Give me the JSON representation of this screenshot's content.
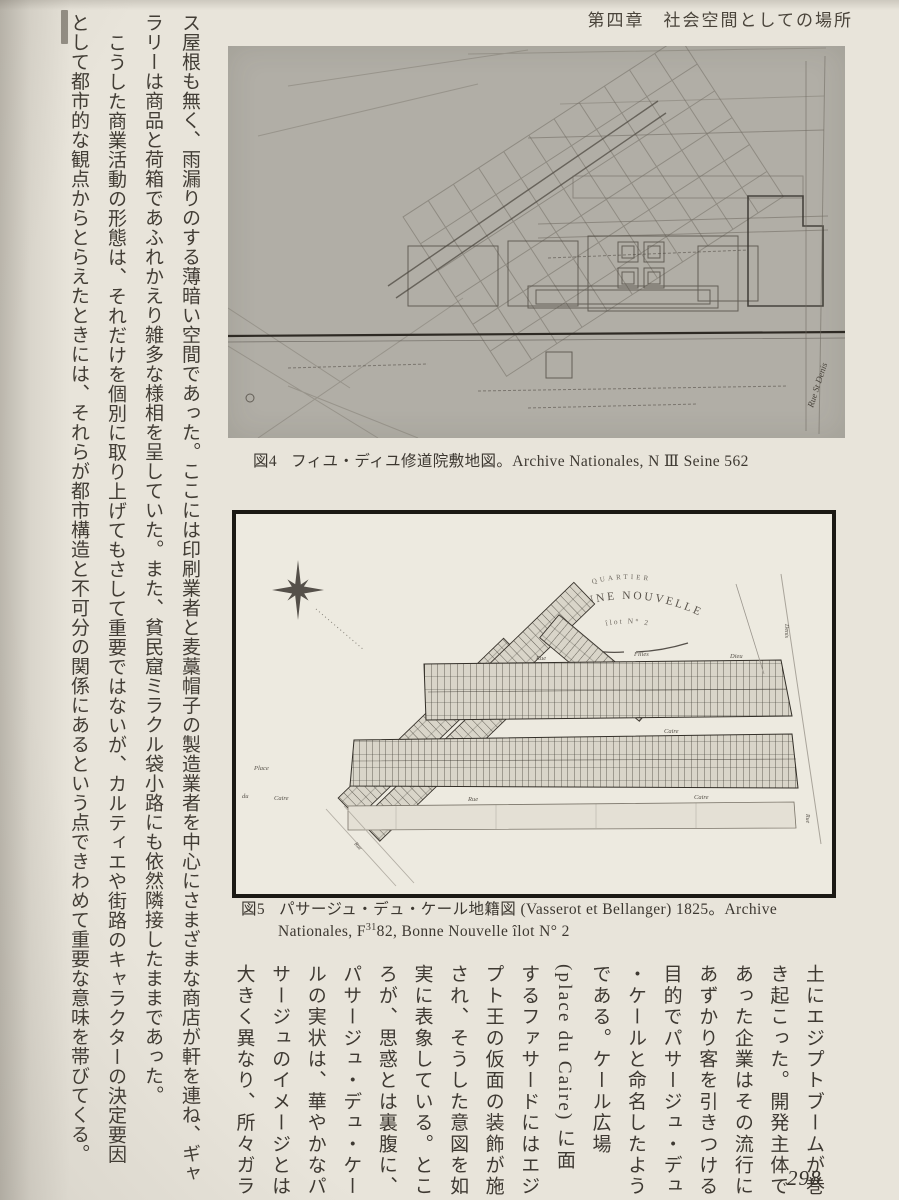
{
  "page": {
    "header": "第四章　社会空間としての場所",
    "page_number": "298"
  },
  "left_text": {
    "columns": [
      "ス屋根も無く、雨漏りのする薄暗い空間であった。ここには印刷業者と麦藁帽子の製造業者を中心にさまざまな商店が軒を連ね、ギャ",
      "ラリーは商品と荷箱であふれかえり雑多な様相を呈していた。また、貧民窟ミラクル袋小路にも依然隣接したままであった。",
      "こうした商業活動の形態は、それだけを個別に取り上げてもさして重要ではないが、カルティエや街路のキャラクターの決定要因",
      "として都市的な観点からとらえたときには、それらが都市構造と不可分の関係にあるという点できわめて重要な意味を帯びてくる。"
    ]
  },
  "figure4": {
    "caption_label": "図4",
    "caption_text": "フィユ・ディユ修道院敷地図。Archive Nationales, N Ⅲ Seine 562",
    "street_label": "Rue St Denis"
  },
  "figure5": {
    "caption_label": "図5",
    "caption_line1": "パサージュ・デュ・ケール地籍図 (Vasserot et Bellanger) 1825。Archive",
    "caption_line2_pre": "Nationales, F",
    "caption_line2_sup": "31",
    "caption_line2_post": "82, Bonne Nouvelle îlot N° 2",
    "cartouche": {
      "line1": "QUARTIER",
      "line2": "BONNE NOUVELLE",
      "line3": "îlot N° 2"
    },
    "labels": {
      "top_rue": "Rue",
      "top_filles": "Filles",
      "top_dieu": "Dieu",
      "mid_caire": "Caire",
      "bottom_rue": "Rue",
      "bottom_caire": "Caire",
      "place1": "Place",
      "place2": "du",
      "place3": "Caire",
      "right_denis": "Denis",
      "right_edge_rue": "Rue",
      "diag_rue": "Rue"
    }
  },
  "bottom_text": {
    "columns": [
      "土にエジプトブームが巻",
      "き起こった。開発主体で",
      "あった企業はその流行に",
      "あずかり客を引きつける",
      "目的でパサージュ・デュ",
      "・ケールと命名したよう",
      "である。ケール広場",
      "(place du Caire) に面",
      "するファサードにはエジ",
      "プト王の仮面の装飾が施",
      "され、そうした意図を如",
      "実に表象している。とこ",
      "ろが、思惑とは裏腹に、",
      "パサージュ・デュ・ケー",
      "ルの実状は、華やかなパ",
      "サージュのイメージとは",
      "大きく異なり、所々ガラ"
    ]
  }
}
